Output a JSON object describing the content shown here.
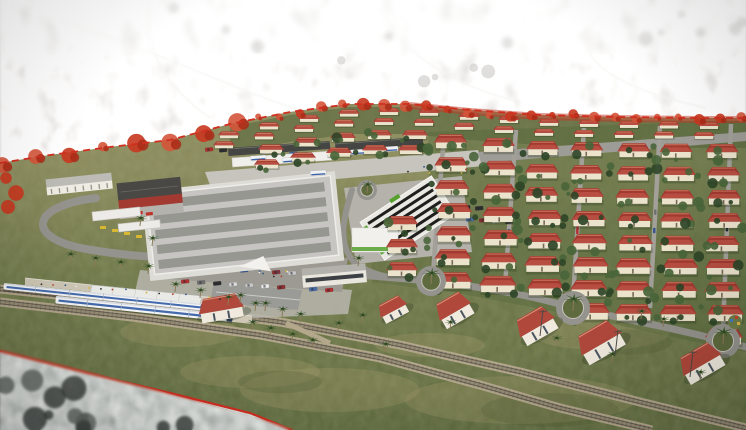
{
  "meta": {
    "type": "aerial-3d-architectural-rendering",
    "subject": "Aerial rendering of a master-planned railside housing community: grids of red-roofed houses, commercial center, striped market hall, bus terminal, parking lots, palm-lined streets, roundabouts and a railway station with two blue-and-white trains; the surrounding existing city is desaturated beyond a red dashed project boundary"
  },
  "palette": {
    "city_light": "#cfcecb",
    "haze": "#ffffff",
    "ground": "#8a8a5c",
    "ground_low": "#6d7648",
    "ground_deep": "#5e6a3e",
    "dry": "#a79c6d",
    "road": "#95938d",
    "road_light": "#c6c4bc",
    "concrete": "#b8b6ae",
    "roof_red": "#a23a31",
    "roof_red_front": "#bb5244",
    "roof_ridge": "#d98c6e",
    "wall": "#ece3cd",
    "tree_dark": "#2e4527",
    "tree_light": "#49653a",
    "palm": "#3d5a2e",
    "trunk": "#8a7a58",
    "boundary": "#d02f1f",
    "ballast": "#b3a78c",
    "ballast_mid": "#988d75",
    "rail": "#5e594f",
    "train_white": "#f4f5f7",
    "train_blue": "#3a62a8",
    "train_nose": "#2a3a55",
    "canopy_dark": "#454543",
    "mall_roof": "#c6c5c1",
    "mall_stripe": "#8e8e8a",
    "dark_roof": "#4a4845",
    "fire_red": "#a33a31",
    "truck_red": "#c23227",
    "market_wall": "#e9e8e3",
    "market_stripe": "#1e1e1d",
    "market_green": "#56a02e",
    "taxi_yellow": "#d8b92f",
    "platform": "#cfc8b6",
    "shadow": "#2f3a22"
  },
  "seed": 13,
  "boundary": {
    "points": [
      [
        0,
        163
      ],
      [
        50,
        155
      ],
      [
        110,
        147
      ],
      [
        170,
        140
      ],
      [
        230,
        124
      ],
      [
        290,
        112
      ],
      [
        350,
        104
      ],
      [
        410,
        104
      ],
      [
        470,
        110
      ],
      [
        540,
        115
      ],
      [
        620,
        117
      ],
      [
        700,
        118
      ],
      [
        746,
        118
      ]
    ],
    "corner": [
      [
        0,
        351
      ],
      [
        80,
        371
      ],
      [
        170,
        393
      ],
      [
        250,
        413
      ],
      [
        292,
        430
      ]
    ],
    "left_trees": [
      [
        6,
        178
      ],
      [
        16,
        193
      ],
      [
        8,
        207
      ]
    ],
    "tree_step": 21,
    "band_from_x": 380,
    "dash": "7 5"
  },
  "railway": {
    "tracks": [
      [
        [
          0,
          289
        ],
        [
          150,
          305
        ],
        [
          280,
          322
        ],
        [
          400,
          345
        ],
        [
          520,
          372
        ],
        [
          640,
          402
        ],
        [
          746,
          428
        ]
      ],
      [
        [
          0,
          302
        ],
        [
          140,
          318
        ],
        [
          260,
          335
        ],
        [
          380,
          358
        ],
        [
          480,
          385
        ],
        [
          560,
          408
        ],
        [
          652,
          430
        ]
      ]
    ],
    "crossover": [
      [
        286,
        323
      ],
      [
        330,
        343
      ]
    ]
  },
  "trains": [
    {
      "x": 4,
      "y": 283,
      "len": 204,
      "h": 6.5
    },
    {
      "x": 56,
      "y": 296,
      "len": 178,
      "h": 7.5
    }
  ],
  "station": {
    "forecourt": [
      [
        140,
        270
      ],
      [
        352,
        290
      ],
      [
        348,
        314
      ],
      [
        255,
        318
      ],
      [
        135,
        292
      ]
    ],
    "platforms": [
      [
        [
          25,
          278
        ],
        [
          245,
          301
        ],
        [
          245,
          308
        ],
        [
          25,
          285
        ]
      ],
      [
        [
          58,
          295
        ],
        [
          252,
          316
        ],
        [
          252,
          324
        ],
        [
          58,
          303
        ]
      ]
    ],
    "canopy": [
      [
        92,
        285
      ],
      [
        202,
        296
      ],
      [
        200,
        304
      ],
      [
        90,
        293
      ]
    ],
    "hall": [
      [
        214,
        282
      ],
      [
        302,
        290
      ],
      [
        298,
        310
      ],
      [
        210,
        302
      ]
    ]
  },
  "roads": {
    "plaza": [
      [
        205,
        172
      ],
      [
        478,
        150
      ],
      [
        484,
        166
      ],
      [
        212,
        190
      ]
    ],
    "right_road": [
      [
        478,
        152
      ],
      [
        746,
        132
      ],
      [
        746,
        141
      ],
      [
        481,
        163
      ]
    ],
    "market_apron": [
      [
        344,
        188
      ],
      [
        462,
        176
      ],
      [
        472,
        252
      ],
      [
        356,
        264
      ]
    ],
    "paths": [
      {
        "d": "M96,198 C28,206 24,240 92,250 C122,255 150,257 170,257",
        "w": 8
      },
      {
        "d": "M168,258 C260,268 350,274 431,281 C505,290 540,298 573,308 C640,322 692,332 746,347",
        "w": 7
      },
      {
        "d": "M352,190 C342,222 338,244 354,262",
        "w": 6
      },
      {
        "d": "M205,270 L258,290",
        "w": 5
      },
      {
        "d": "M354,262 C372,276 400,280 420,278",
        "w": 5
      }
    ],
    "estate_streets": [
      [
        433,
        272,
        444,
        136
      ],
      [
        505,
        286,
        516,
        130
      ],
      [
        573,
        298,
        584,
        128
      ],
      [
        650,
        308,
        660,
        126
      ],
      [
        723,
        330,
        731,
        124
      ]
    ]
  },
  "parking": {
    "main_poly": [
      [
        162,
        246
      ],
      [
        348,
        258
      ],
      [
        342,
        292
      ],
      [
        156,
        278
      ]
    ],
    "rows": [
      {
        "x": 172,
        "y": 251,
        "n": 11,
        "step": 16,
        "slope": 0.06
      },
      {
        "x": 176,
        "y": 265,
        "n": 11,
        "step": 16,
        "slope": 0.06
      },
      {
        "x": 181,
        "y": 280,
        "n": 10,
        "step": 16,
        "slope": 0.06
      }
    ],
    "north_row": {
      "x": 205,
      "y": 148,
      "n": 9,
      "step": 14,
      "slope": 0.05
    },
    "market_rows": [
      {
        "x": 462,
        "y": 206,
        "n": 4,
        "step": 13,
        "slope": 0.06
      },
      {
        "x": 466,
        "y": 218,
        "n": 4,
        "step": 13,
        "slope": 0.06
      }
    ],
    "car_colors": [
      "#d8d8d8",
      "#2e2e2e",
      "#b03030",
      "#33548e",
      "#c8c8c8",
      "#6f6f6f",
      "#e9e9e9",
      "#8e2f2f",
      "#4a6ea8",
      "#1f2a38"
    ]
  },
  "terminal": {
    "canopies": [
      [
        228,
        148,
        102,
        8,
        -4
      ],
      [
        335,
        143,
        88,
        8,
        -4
      ]
    ],
    "concourse": [
      232,
      158,
      100,
      9,
      -4
    ],
    "buses": [
      [
        250,
        156
      ],
      [
        282,
        158
      ],
      [
        350,
        150
      ],
      [
        382,
        147
      ],
      [
        310,
        171
      ]
    ]
  },
  "commercial": {
    "mall": {
      "rot": -6,
      "base": [
        150,
        185,
        185,
        80
      ],
      "strips": 5
    },
    "market": {
      "rot": -33,
      "cx": 408,
      "cy": 218,
      "w": 85,
      "h": 45,
      "annex": [
        352,
        228,
        46,
        24
      ]
    },
    "fire": {
      "rot": -6,
      "roof": [
        118,
        180,
        64,
        18
      ],
      "wall": [
        118,
        197,
        64,
        9
      ],
      "apron": [
        118,
        206,
        64,
        10
      ],
      "trucks": [
        [
          124,
          208
        ],
        [
          134,
          210
        ],
        [
          144,
          212
        ]
      ]
    },
    "nw": {
      "rot": -6,
      "roof": [
        46,
        176,
        66,
        9
      ],
      "wall": [
        46,
        184,
        66,
        8
      ]
    },
    "east": {
      "rot": -5,
      "roof": [
        303,
        266,
        64,
        8
      ],
      "wall": [
        303,
        273,
        64,
        12
      ],
      "win": [
        306,
        276,
        58,
        4
      ]
    },
    "taxi_canopies": [
      [
        92,
        212,
        48,
        9,
        -6
      ],
      [
        118,
        224,
        42,
        8,
        -6
      ]
    ],
    "taxis": [
      [
        100,
        226
      ],
      [
        112,
        229
      ],
      [
        124,
        232
      ],
      [
        136,
        235
      ]
    ]
  },
  "roundabouts": [
    [
      367,
      190,
      10
    ],
    [
      431,
      281,
      15
    ],
    [
      573,
      308,
      17
    ],
    [
      723,
      341,
      17
    ]
  ],
  "standalone": [
    [
      198,
      296,
      46,
      24,
      -10
    ],
    [
      378,
      299,
      30,
      20,
      -28
    ],
    [
      436,
      296,
      36,
      27,
      -30
    ],
    [
      516,
      311,
      40,
      28,
      -30
    ],
    [
      577,
      326,
      46,
      31,
      -30
    ],
    [
      679,
      348,
      44,
      29,
      -30
    ]
  ],
  "housing": {
    "far": {
      "x0": 218,
      "x1": 736,
      "step": 40,
      "offsets": [
        4,
        14
      ],
      "w": 22,
      "h": 7
    },
    "upper": {
      "x0": 258,
      "x1": 430,
      "step": 36,
      "offsets": [
        26,
        41
      ],
      "w": 26,
      "h": 9
    },
    "mid_col": {
      "x": 386,
      "y0": 216,
      "n": 3,
      "pitch": 23,
      "w": 32,
      "h": 14
    },
    "main": {
      "x0": 436,
      "cols": 7,
      "pitch": 45,
      "row_pitch": 23,
      "w": 33,
      "h": 14,
      "top_off": 26,
      "bot": [
        282,
        290,
        298,
        306,
        314,
        322,
        330
      ]
    }
  },
  "palms": [
    [
      252,
      330
    ],
    [
      270,
      336
    ],
    [
      292,
      342
    ],
    [
      312,
      348
    ],
    [
      338,
      331
    ],
    [
      362,
      323
    ],
    [
      385,
      352
    ],
    [
      300,
      322
    ],
    [
      265,
      311
    ],
    [
      240,
      303
    ],
    [
      175,
      292
    ],
    [
      200,
      298
    ],
    [
      228,
      305
    ],
    [
      255,
      311
    ],
    [
      282,
      317
    ],
    [
      70,
      262
    ],
    [
      95,
      266
    ],
    [
      120,
      270
    ],
    [
      148,
      274
    ],
    [
      140,
      226
    ],
    [
      152,
      246
    ],
    [
      358,
      266
    ],
    [
      450,
      330
    ],
    [
      556,
      346
    ],
    [
      612,
      362
    ],
    [
      641,
      319
    ],
    [
      663,
      327
    ],
    [
      700,
      380
    ]
  ],
  "poles": [
    [
      540,
      336
    ],
    [
      615,
      356
    ],
    [
      690,
      377
    ]
  ],
  "playground": [
    735,
    322
  ],
  "field_patches": [
    [
      330,
      390,
      90,
      22
    ],
    [
      520,
      400,
      115,
      24
    ],
    [
      180,
      332,
      60,
      15
    ],
    [
      600,
      332,
      70,
      18
    ],
    [
      430,
      345,
      55,
      12
    ],
    [
      250,
      372,
      70,
      16
    ]
  ]
}
